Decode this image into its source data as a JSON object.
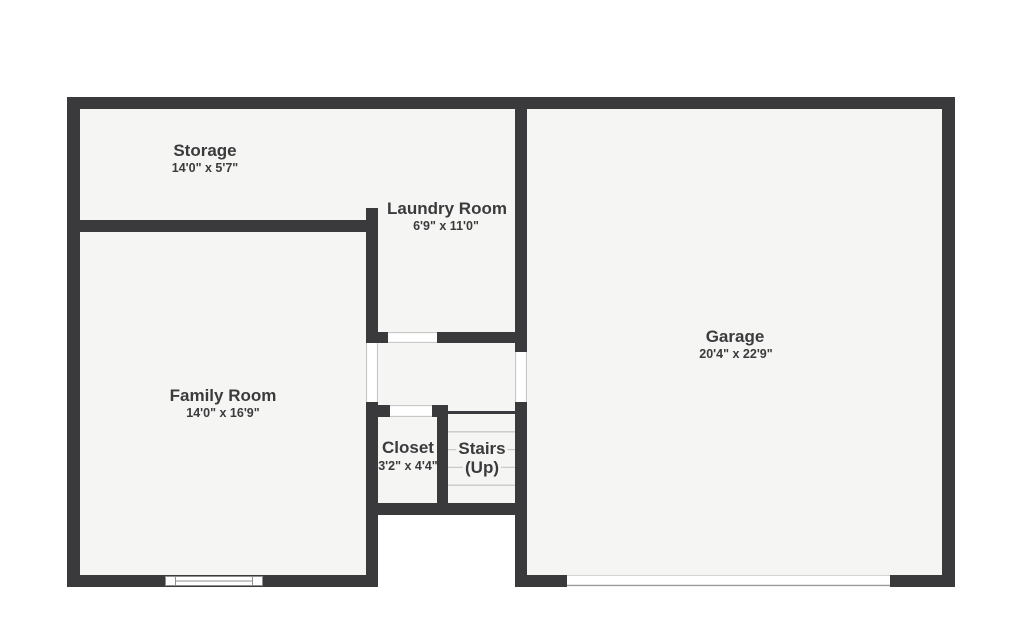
{
  "plan": {
    "colors": {
      "wall": "#3a3a3c",
      "floor": "#f5f5f4",
      "background": "#ffffff",
      "label": "#3b3b3d",
      "tread": "#c9c9c9",
      "opening_line": "#c0c0c0",
      "symbol_outline": "#8f8f8f"
    },
    "rooms": {
      "storage": {
        "name": "Storage",
        "dims": "14'0\" x 5'7\""
      },
      "laundry": {
        "name": "Laundry Room",
        "dims": "6'9\" x 11'0\""
      },
      "garage": {
        "name": "Garage",
        "dims": "20'4\" x 22'9\""
      },
      "family": {
        "name": "Family Room",
        "dims": "14'0\" x 16'9\""
      },
      "closet": {
        "name": "Closet",
        "dims": "3'2\" x 4'4\""
      },
      "stairs": {
        "name": "Stairs",
        "direction": "(Up)"
      }
    }
  }
}
